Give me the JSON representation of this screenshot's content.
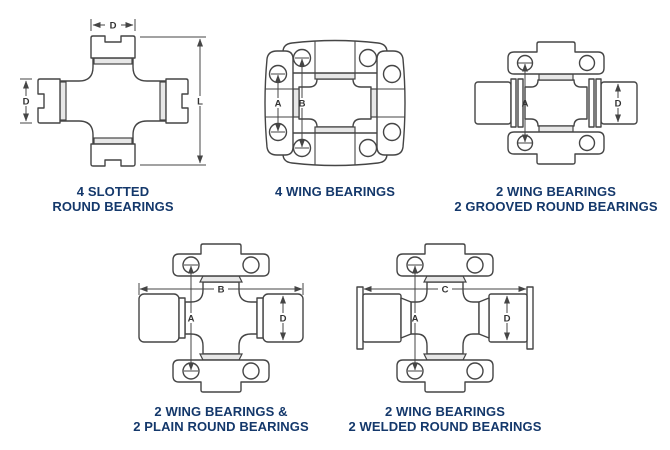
{
  "colors": {
    "background": "#ffffff",
    "line": "#454545",
    "cap_fill": "#e7e7e7",
    "caption_text": "#14386b",
    "dimension_text": "#333333"
  },
  "diagrams": [
    {
      "name": "4-slotted-round-bearings",
      "caption": [
        "4 SLOTTED",
        "ROUND BEARINGS"
      ],
      "dims": {
        "top": "D",
        "left": "D",
        "right": "L"
      }
    },
    {
      "name": "4-wing-bearings",
      "caption": [
        "4 WING BEARINGS",
        ""
      ],
      "dims": {
        "wing": "A",
        "across": "B"
      }
    },
    {
      "name": "2-wing-2-grooved-round-bearings",
      "caption": [
        "2 WING BEARINGS",
        "2 GROOVED ROUND BEARINGS"
      ],
      "dims": {
        "across": "A",
        "bearing": "D"
      }
    },
    {
      "name": "2-wing-2-plain-round-bearings",
      "caption": [
        "2 WING BEARINGS &",
        "2 PLAIN ROUND BEARINGS"
      ],
      "dims": {
        "width": "B",
        "across": "A",
        "bearing": "D"
      }
    },
    {
      "name": "2-wing-2-welded-round-bearings",
      "caption": [
        "2 WING BEARINGS",
        "2 WELDED ROUND BEARINGS"
      ],
      "dims": {
        "width": "C",
        "across": "A",
        "bearing": "D"
      }
    }
  ]
}
